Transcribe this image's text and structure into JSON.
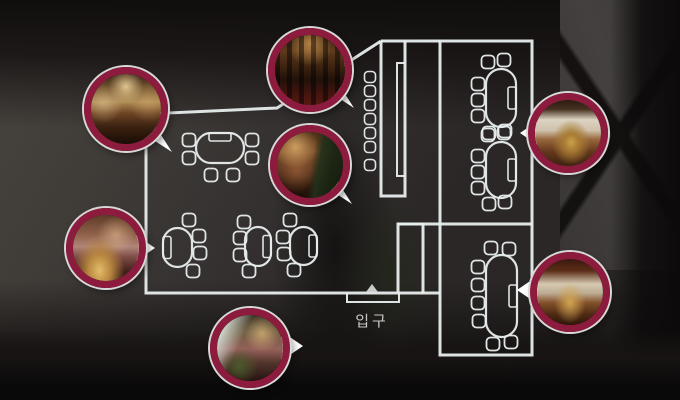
{
  "scene": {
    "description": "Dark restaurant interior photograph overlaid with a white floor plan and seven circular photo callouts",
    "entrance": {
      "label": "입구"
    }
  },
  "colors": {
    "plan-line": "#e8eded",
    "ring": "#8d1b3d",
    "ring-outline": "#d8d8d8",
    "pointer": "#ffffff",
    "label": "#c9c9c9",
    "bg-base": "#272323"
  },
  "photos": [
    {
      "id": "photo-main-hall",
      "position": "top-left",
      "pointer": "se",
      "gradient": "radial-gradient(circle at 50% 18%, rgba(244,216,160,0.85) 0%, rgba(244,216,160,0) 26%), radial-gradient(circle at 18% 42%, rgba(225,195,150,0.55) 0%, rgba(225,195,150,0) 28%), radial-gradient(circle at 82% 40%, rgba(210,170,110,0.5) 0%, rgba(210,170,110,0) 28%), linear-gradient(180deg, #3a2513 0%, #7c5c34 24%, #ad8a52 40%, #6d4424 56%, #3a2110 76%, #190c04 100%)"
    },
    {
      "id": "photo-bar-counter",
      "position": "top-middle",
      "pointer": "se",
      "gradient": "repeating-linear-gradient(90deg, rgba(15,8,6,0.55) 0px, rgba(15,8,6,0.55) 5px, rgba(90,50,25,0.15) 5px, rgba(90,50,25,0.15) 12px), radial-gradient(circle at 50% 12%, rgba(235,175,95,0.75) 0%, rgba(235,175,95,0) 32%), linear-gradient(180deg, #2e1c0e 0%, #5e3d1e 22%, #3a2210 44%, #170c07 64%, #3e100c 84%, #55160f 100%)"
    },
    {
      "id": "photo-tree-dining",
      "position": "middle",
      "pointer": "se",
      "gradient": "linear-gradient(100deg, rgba(0,0,0,0) 52%, rgba(34,48,26,0.92) 62%, rgba(24,36,18,0.95) 78%, rgba(18,28,14,0.9) 100%), radial-gradient(circle at 28% 22%, rgba(235,185,115,0.75) 0%, rgba(235,185,115,0) 32%), radial-gradient(circle at 30% 60%, rgba(190,120,70,0.5) 0%, rgba(190,120,70,0) 35%), linear-gradient(180deg, #4c2d15 0%, #7d5029 30%, #5c3520 56%, #2f180c 80%, #1e0e07 100%)"
    },
    {
      "id": "photo-grill-table",
      "position": "left",
      "pointer": "e",
      "gradient": "radial-gradient(ellipse at 40% 84%, #e2bc6a 0%, #b98740 20%, rgba(130,80,35,0) 45%), radial-gradient(circle at 65% 30%, rgba(240,205,160,0.5) 0%, rgba(240,205,160,0) 30%), linear-gradient(180deg, #5e3b26 0%, #8d5f48 28%, #b08578 48%, #7c4c44 64%, #45231e 84%, #2c1410 100%)"
    },
    {
      "id": "photo-entrance-lobby",
      "position": "bottom-center",
      "pointer": "e",
      "gradient": "radial-gradient(circle at 34% 78%, rgba(74,96,44,0.85) 0%, rgba(74,96,44,0) 28%), linear-gradient(115deg, rgba(210,220,210,0.9) 14%, rgba(210,220,210,0) 38%), radial-gradient(circle at 68% 28%, rgba(245,205,135,0.6) 0%, rgba(245,205,135,0) 28%), linear-gradient(180deg, #3e3626 0%, #6e5c42 26%, #95605a 52%, #53362c 72%, #241310 100%)"
    },
    {
      "id": "photo-round-table-room",
      "position": "right",
      "pointer": "w",
      "gradient": "radial-gradient(ellipse at 55% 64%, #caa04a 0%, #a87c34 14%, rgba(150,105,45,0) 38%), linear-gradient(180deg, #2c1c10 0%, #463020 14%, #dcd3c2 30%, #cfc2ac 46%, #96653a 60%, #64381c 78%, #3c2210 100%)"
    },
    {
      "id": "photo-beamed-private-room",
      "position": "bottom-right",
      "pointer": "w",
      "gradient": "radial-gradient(ellipse at 50% 66%, #d0a452 0%, rgba(160,110,45,0) 34%), linear-gradient(180deg, #3c170e 0%, #5c2e18 18%, #d6c9b2 38%, #bcab92 52%, #84512a 66%, #4e2a14 84%, #2e1608 100%)"
    }
  ],
  "floorplan": {
    "chair_size": 13,
    "stool_size": 11,
    "tables": [
      {
        "x": 196,
        "y": 133,
        "w": 48,
        "h": 30,
        "bench": "top",
        "chairs": [
          [
            189,
            140
          ],
          [
            189,
            158
          ],
          [
            211,
            175
          ],
          [
            233,
            175
          ],
          [
            252,
            140
          ],
          [
            252,
            158
          ]
        ]
      },
      {
        "x": 163,
        "y": 228,
        "w": 29,
        "h": 39,
        "bench": "left",
        "chairs": [
          [
            189,
            220
          ],
          [
            199,
            236
          ],
          [
            200,
            253
          ],
          [
            193,
            271
          ]
        ]
      },
      {
        "x": 245,
        "y": 227,
        "w": 26,
        "h": 39,
        "bench": "right",
        "chairs": [
          [
            244,
            222
          ],
          [
            240,
            238
          ],
          [
            240,
            255
          ],
          [
            249,
            271
          ]
        ]
      },
      {
        "x": 290,
        "y": 227,
        "w": 27,
        "h": 38,
        "bench": "right",
        "chairs": [
          [
            290,
            220
          ],
          [
            283,
            237
          ],
          [
            284,
            254
          ],
          [
            294,
            270
          ]
        ]
      },
      {
        "x": 486,
        "y": 69,
        "w": 30,
        "h": 58,
        "bench": "right",
        "chairs": [
          [
            488,
            62
          ],
          [
            504,
            60
          ],
          [
            478,
            84
          ],
          [
            478,
            100
          ],
          [
            478,
            116
          ],
          [
            489,
            133
          ],
          [
            505,
            131
          ]
        ]
      },
      {
        "x": 486,
        "y": 142,
        "w": 30,
        "h": 56,
        "bench": "right",
        "chairs": [
          [
            488,
            135
          ],
          [
            504,
            133
          ],
          [
            478,
            156
          ],
          [
            478,
            172
          ],
          [
            478,
            188
          ],
          [
            489,
            204
          ],
          [
            505,
            202
          ]
        ]
      },
      {
        "x": 486,
        "y": 255,
        "w": 31,
        "h": 82,
        "bench": "right",
        "chairs": [
          [
            491,
            248
          ],
          [
            509,
            249
          ],
          [
            478,
            267
          ],
          [
            478,
            285
          ],
          [
            478,
            303
          ],
          [
            479,
            321
          ],
          [
            493,
            344
          ],
          [
            511,
            342
          ]
        ]
      }
    ],
    "stools": [
      [
        370,
        77
      ],
      [
        370,
        91
      ],
      [
        370,
        105
      ],
      [
        370,
        119
      ],
      [
        370,
        133
      ],
      [
        370,
        147
      ],
      [
        370,
        165
      ]
    ]
  }
}
